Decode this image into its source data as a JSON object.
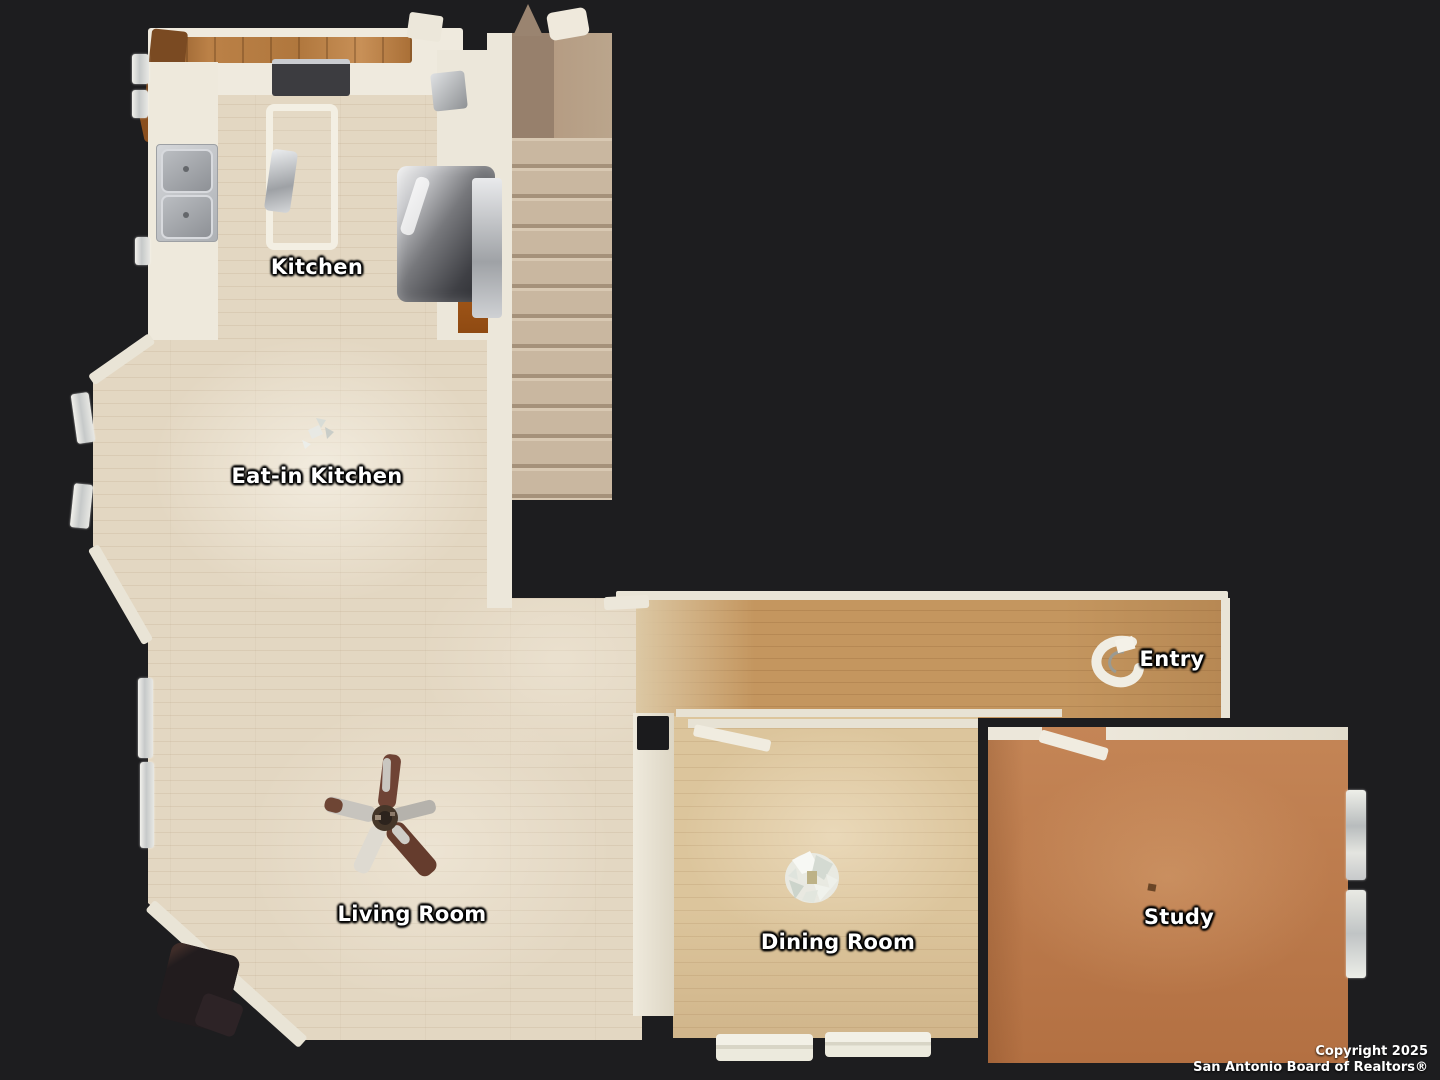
{
  "floorplan": {
    "type": "top-down-floor-plan",
    "rooms": [
      {
        "id": "kitchen",
        "label": "Kitchen"
      },
      {
        "id": "eat-in-kitchen",
        "label": "Eat-in Kitchen"
      },
      {
        "id": "entry",
        "label": "Entry"
      },
      {
        "id": "living-room",
        "label": "Living Room"
      },
      {
        "id": "dining-room",
        "label": "Dining Room"
      },
      {
        "id": "study",
        "label": "Study"
      }
    ],
    "fixtures": [
      "kitchen-sink",
      "range",
      "refrigerator",
      "kitchen-island",
      "staircase",
      "ceiling-fan",
      "dining-chandelier",
      "entry-console",
      "windows",
      "interior-doors",
      "media-cabinet"
    ],
    "colors": {
      "background": "#1d1d1f",
      "floor_light_wood": "#e3d7c2",
      "floor_hall_wood": "#c4965f",
      "floor_dining_wood": "#dcc59c",
      "floor_study_wood": "#bc7a4a",
      "stairs_carpet": "#c9b7a0",
      "walls": "#ece7da",
      "label_text": "#ffffff"
    }
  },
  "footer": {
    "copyright_line1": "Copyright 2025",
    "copyright_line2": "San Antonio Board of Realtors®"
  }
}
